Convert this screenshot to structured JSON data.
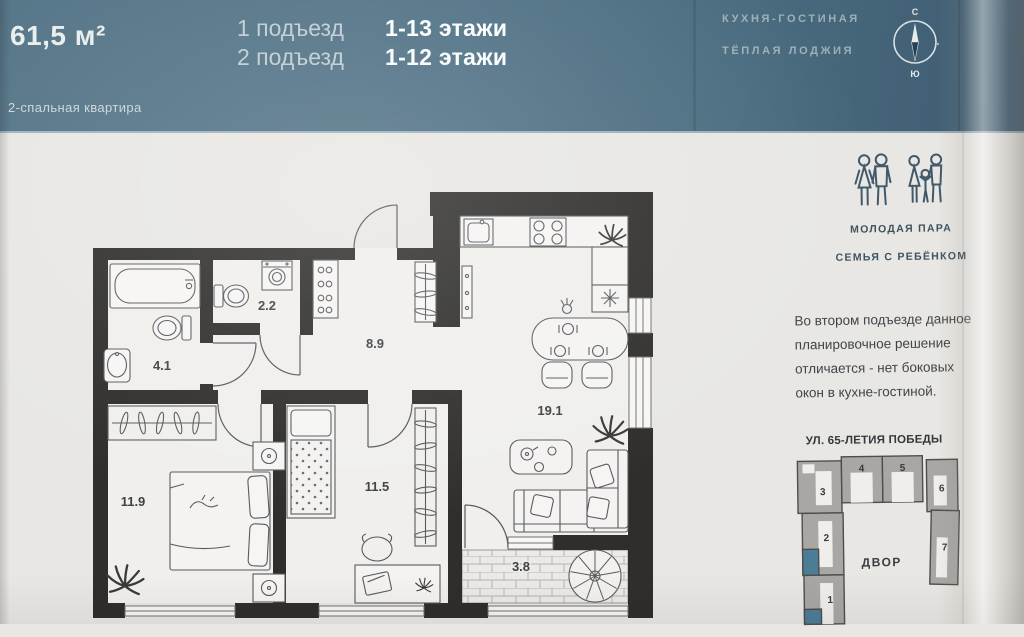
{
  "header": {
    "area": "61,5 м²",
    "type_label": "2-спальная квартира",
    "entrances": [
      {
        "name": "1 подъезд",
        "floors": "1-13 этажи"
      },
      {
        "name": "2 подъезд",
        "floors": "1-12 этажи"
      }
    ],
    "features": [
      "КУХНЯ-ГОСТИНАЯ",
      "ТЁПЛАЯ ЛОДЖИЯ"
    ],
    "compass": {
      "north": "С",
      "south": "Ю"
    }
  },
  "floorplan": {
    "room_areas": {
      "bathroom": "4.1",
      "wc": "2.2",
      "hall": "8.9",
      "bedroom1": "11.9",
      "bedroom2": "11.5",
      "kitchen_living": "19.1",
      "loggia": "3.8"
    }
  },
  "audience": {
    "labels": [
      "МОЛОДАЯ ПАРА",
      "СЕМЬЯ С РЕБЁНКОМ"
    ],
    "note": "Во втором подъезде данное планировочное решение отличается - нет боковых окон в кухне-гостиной."
  },
  "siteplan": {
    "street": "УЛ. 65-ЛЕТИЯ ПОБЕДЫ",
    "courtyard": "ДВОР",
    "building_numbers": [
      "1",
      "2",
      "3",
      "4",
      "5",
      "6",
      "7"
    ]
  },
  "colors": {
    "band": "#4e7084",
    "accent": "#4c7d96",
    "wall": "#2f2e2c"
  }
}
